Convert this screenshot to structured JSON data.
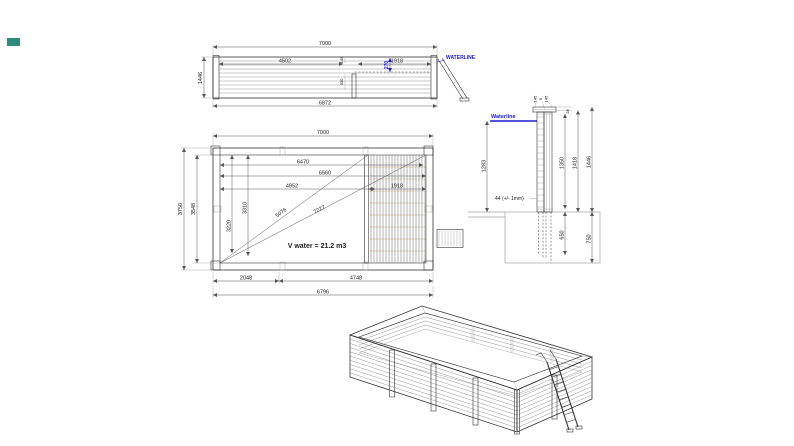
{
  "window": {
    "background": "#ffffff"
  },
  "marker_chip": {
    "color": "#2e8b7a"
  },
  "colors": {
    "waterline_blue": "#1b1bd1",
    "wood_fill": "#f1e4c9",
    "post_brown": "#9b5b2b",
    "ground_grey": "#b8b8b8",
    "line_dark": "#333333"
  },
  "views": {
    "elevation": {
      "waterline_label": "WATERLINE",
      "dims": {
        "overall_length": "7000",
        "height": "1446",
        "base_length": "6872",
        "left_segment": "4502",
        "right_segment": "1918",
        "waterline_drop": "270",
        "detail_top": "145",
        "detail_mid": "330"
      }
    },
    "plan": {
      "volume_label": "V water = 21.2 m3",
      "dims": {
        "overall_length": "7000",
        "overall_width": "3750",
        "inner_width": "3548",
        "inner_length_a": "6470",
        "inner_length_b": "6560",
        "inner_length_c": "4952",
        "diagonal_a": "5076",
        "diagonal_b": "7227",
        "width_a": "3310",
        "width_b": "3220",
        "deck_length": "1918",
        "bottom_a": "2048",
        "bottom_b": "4748",
        "bottom_total": "6796"
      }
    },
    "section": {
      "waterline_label": "Waterline",
      "plank_note": "44 (+/- 1mm)",
      "dims": {
        "cap_front": "145",
        "cap_gap": "5",
        "cap_back": "145",
        "rim_height": "28",
        "inner_height": "1350",
        "wall_height": "1418",
        "total_height": "1446",
        "water_height": "1283",
        "buried_inner": "650",
        "buried_outer": "750"
      }
    }
  }
}
